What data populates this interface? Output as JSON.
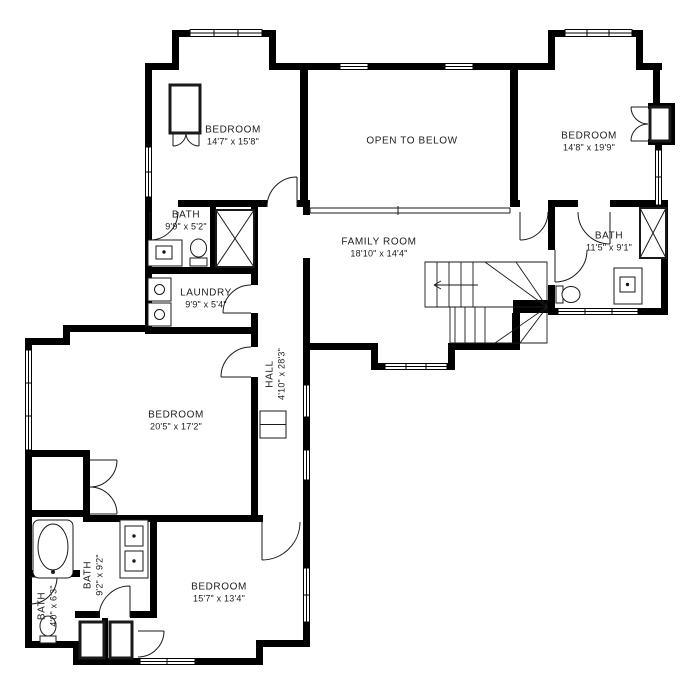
{
  "plan": {
    "type": "second-floor-plan",
    "colors": {
      "wall": "#000000",
      "background": "#ffffff",
      "line": "#1a1a1a"
    },
    "rooms": [
      {
        "id": "bedroom-top-left",
        "name": "BEDROOM",
        "dims": "14'7\" x 15'8\""
      },
      {
        "id": "open-to-below",
        "name": "OPEN TO BELOW",
        "dims": ""
      },
      {
        "id": "bedroom-top-right",
        "name": "BEDROOM",
        "dims": "14'8\" x 19'9\""
      },
      {
        "id": "bath-top-left",
        "name": "BATH",
        "dims": "9'9\" x 5'2\""
      },
      {
        "id": "family-room",
        "name": "FAMILY ROOM",
        "dims": "18'10\" x 14'4\""
      },
      {
        "id": "bath-right",
        "name": "BATH",
        "dims": "11'5\" x 9'1\""
      },
      {
        "id": "laundry",
        "name": "LAUNDRY",
        "dims": "9'9\" x 5'4\""
      },
      {
        "id": "hall",
        "name": "HALL",
        "dims": "4'10\" x 28'3\""
      },
      {
        "id": "bedroom-middle-left",
        "name": "BEDROOM",
        "dims": "20'5\" x 17'2\""
      },
      {
        "id": "bath-bottom-left",
        "name": "BATH",
        "dims": "9'2\" x 9'2\""
      },
      {
        "id": "bath-bottom-corner",
        "name": "BATH",
        "dims": "4'0\" x 6'3\""
      },
      {
        "id": "bedroom-bottom",
        "name": "BEDROOM",
        "dims": "15'7\" x 13'4\""
      }
    ]
  }
}
